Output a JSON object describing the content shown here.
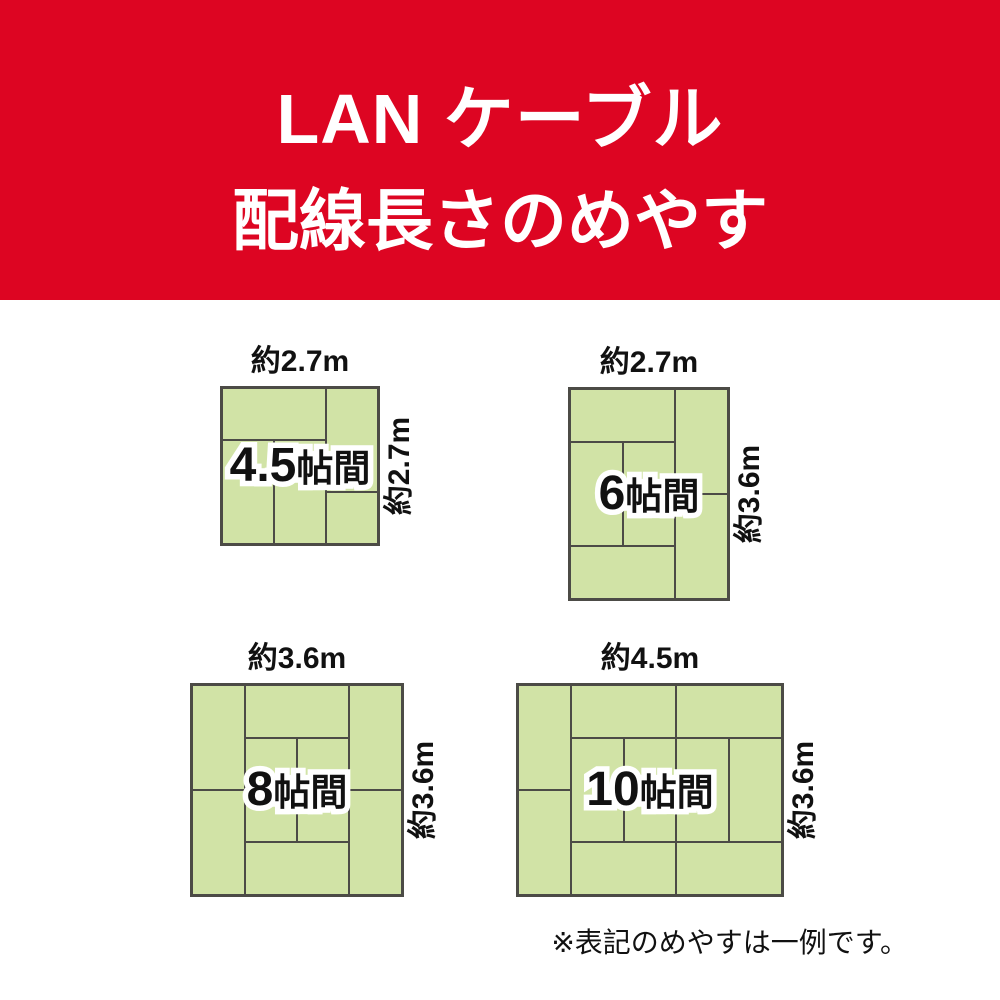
{
  "banner": {
    "title_line1": "LAN ケーブル",
    "title_line2": "配線長さのめやす"
  },
  "colors": {
    "banner_bg": "#dd0522",
    "title_text": "#ffffff",
    "tatami_fill": "#d1e3a6",
    "tatami_line": "#4c4b46",
    "label_text": "#111111",
    "label_outline": "#ffffff",
    "page_bg": "#ffffff"
  },
  "rooms": [
    {
      "id": "4-5jo",
      "size_number": "4.5",
      "size_suffix": "帖間",
      "top_dimension": "約2.7m",
      "side_dimension": "約2.7m",
      "box": {
        "left": 220,
        "top": 386,
        "width": 160,
        "height": 160
      },
      "lines": [
        {
          "dir": "v",
          "pos": 0.6667,
          "from": 0,
          "to": 1
        },
        {
          "dir": "v",
          "pos": 0.3333,
          "from": 0.3333,
          "to": 1
        },
        {
          "dir": "h",
          "pos": 0.3333,
          "from": 0,
          "to": 0.6667
        },
        {
          "dir": "h",
          "pos": 0.6667,
          "from": 0.6667,
          "to": 1
        }
      ]
    },
    {
      "id": "6jo",
      "size_number": "6",
      "size_suffix": "帖間",
      "top_dimension": "約2.7m",
      "side_dimension": "約3.6m",
      "box": {
        "left": 568,
        "top": 387,
        "width": 162,
        "height": 214
      },
      "lines": [
        {
          "dir": "v",
          "pos": 0.6667,
          "from": 0,
          "to": 1
        },
        {
          "dir": "v",
          "pos": 0.3333,
          "from": 0.25,
          "to": 0.75
        },
        {
          "dir": "h",
          "pos": 0.25,
          "from": 0,
          "to": 0.6667
        },
        {
          "dir": "h",
          "pos": 0.75,
          "from": 0,
          "to": 0.6667
        },
        {
          "dir": "h",
          "pos": 0.5,
          "from": 0.6667,
          "to": 1
        }
      ]
    },
    {
      "id": "8jo",
      "size_number": "8",
      "size_suffix": "帖間",
      "top_dimension": "約3.6m",
      "side_dimension": "約3.6m",
      "box": {
        "left": 190,
        "top": 683,
        "width": 214,
        "height": 214
      },
      "lines": [
        {
          "dir": "v",
          "pos": 0.25,
          "from": 0,
          "to": 1
        },
        {
          "dir": "v",
          "pos": 0.75,
          "from": 0,
          "to": 1
        },
        {
          "dir": "v",
          "pos": 0.5,
          "from": 0.25,
          "to": 0.75
        },
        {
          "dir": "h",
          "pos": 0.25,
          "from": 0.25,
          "to": 0.75
        },
        {
          "dir": "h",
          "pos": 0.75,
          "from": 0.25,
          "to": 0.75
        },
        {
          "dir": "h",
          "pos": 0.5,
          "from": 0,
          "to": 0.25
        },
        {
          "dir": "h",
          "pos": 0.5,
          "from": 0.75,
          "to": 1
        }
      ]
    },
    {
      "id": "10jo",
      "size_number": "10",
      "size_suffix": "帖間",
      "top_dimension": "約4.5m",
      "side_dimension": "約3.6m",
      "box": {
        "left": 516,
        "top": 683,
        "width": 268,
        "height": 214
      },
      "lines": [
        {
          "dir": "v",
          "pos": 0.2,
          "from": 0,
          "to": 1
        },
        {
          "dir": "v",
          "pos": 0.6,
          "from": 0,
          "to": 1
        },
        {
          "dir": "v",
          "pos": 0.4,
          "from": 0.25,
          "to": 0.75
        },
        {
          "dir": "v",
          "pos": 0.8,
          "from": 0.25,
          "to": 0.75
        },
        {
          "dir": "h",
          "pos": 0.25,
          "from": 0.2,
          "to": 1
        },
        {
          "dir": "h",
          "pos": 0.75,
          "from": 0.2,
          "to": 1
        },
        {
          "dir": "h",
          "pos": 0.5,
          "from": 0,
          "to": 0.2
        }
      ]
    }
  ],
  "footnote": "※表記のめやすは一例です。"
}
